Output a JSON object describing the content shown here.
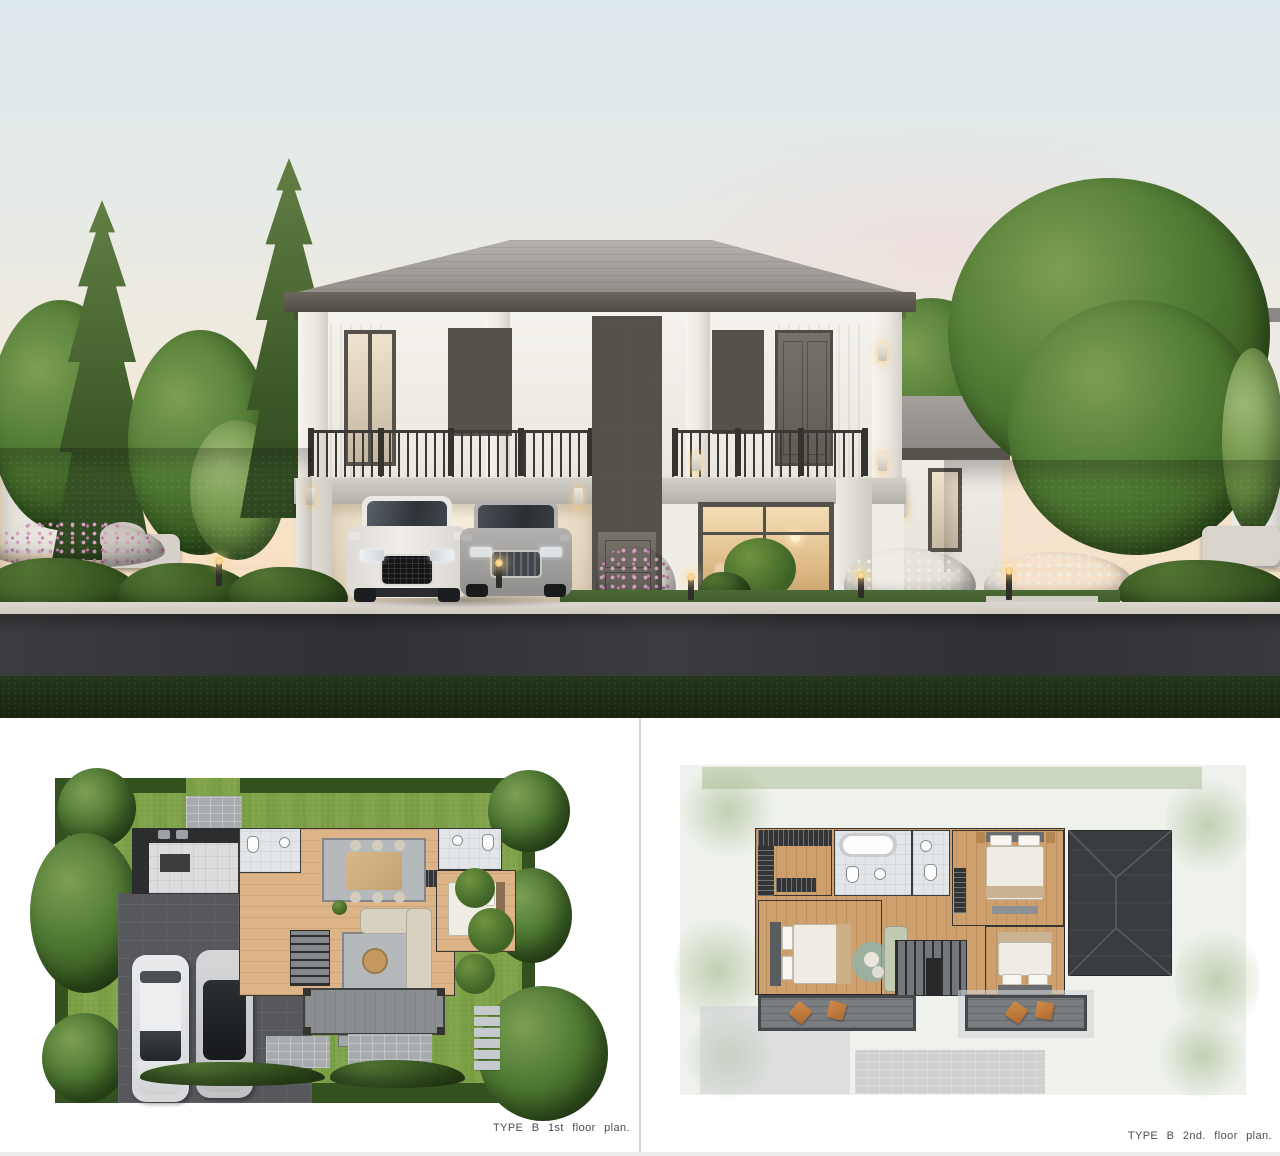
{
  "captions": {
    "floor_plan_1": "TYPE B 1st floor plan.",
    "floor_plan_2": "TYPE B 2nd. floor plan."
  },
  "colors": {
    "sky_top": "#dde8ec",
    "sky_horizon": "#f6e3cc",
    "roof": "#918d89",
    "fascia": "#56524b",
    "wall": "#f2f0ea",
    "window_frame": "#56524b",
    "window_glow": "#e8c896",
    "railing": "#3b3a37",
    "asphalt_road": "#303134",
    "foreground_grass": "#20301a",
    "plan_lawn": "#7ba045",
    "plan_hedge": "#34521f",
    "plan_wood_floor": "#dcb487",
    "plan_driveway": "#56585c",
    "plan_roof": "#3a3d40",
    "balcony_cushion": "#c07a3e",
    "caption_text": "#4c4c4c",
    "panel_divider": "#d8d8d8"
  }
}
